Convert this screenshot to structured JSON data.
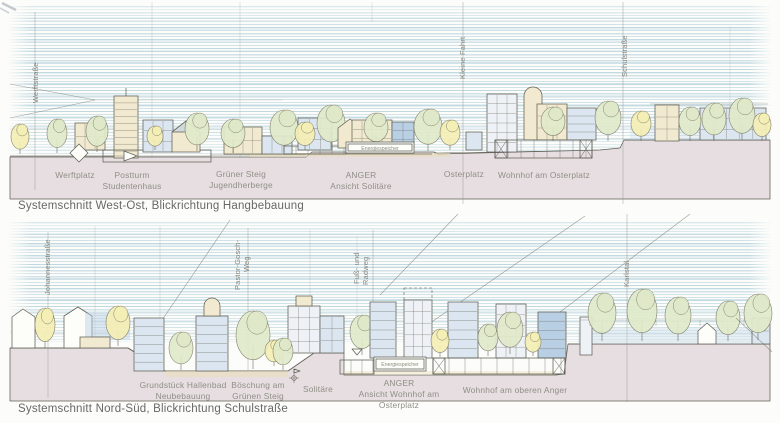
{
  "colors": {
    "paper": "#fcfcfa",
    "sky_stroke": "#7fb0c4",
    "ground": "#e7dee1",
    "pencil": "#5f5f55",
    "pencil_light": "#8f8f86",
    "street_label_text": "#85857f",
    "place_label_text": "#8f8f88",
    "annotation_text": "#8f8f84",
    "caption_text": "#686868",
    "fill_cream": "#f2ead0",
    "fill_yellow": "#f4eeb4",
    "fill_green": "#dfe9c9",
    "fill_blue": "#b9cfe4",
    "fill_bluepale": "#dce6f0",
    "fill_paleblue2": "#eef2f6",
    "fill_white": "#fdfdf9",
    "fill_sand": "#e9ddb4"
  },
  "panels": [
    {
      "name": "west-ost",
      "caption": "Systemschnitt West-Ost, Blickrichtung Hangbebauung",
      "street_labels": [
        {
          "name": "werftstrasse",
          "lines": [
            {
              "text": "Werftstraße",
              "x": 35,
              "y": 103
            }
          ]
        },
        {
          "name": "kleine-fahrt",
          "lines": [
            {
              "text": "Kleine Fahrt",
              "x": 462,
              "y": 79
            }
          ]
        },
        {
          "name": "schulstrasse",
          "lines": [
            {
              "text": "Schulstraße",
              "x": 624,
              "y": 77
            }
          ]
        }
      ],
      "place_labels": [
        {
          "name": "werftplatz",
          "x": 75,
          "y": 178,
          "lines": [
            "Werftplatz"
          ]
        },
        {
          "name": "postturm-studentenhaus",
          "x": 132,
          "y": 178,
          "lines": [
            "Postturm",
            "Studentenhaus"
          ]
        },
        {
          "name": "gruener-steig-jugendherberge",
          "x": 241,
          "y": 177,
          "lines": [
            "Grüner Steig",
            "Jugendherberge"
          ]
        },
        {
          "name": "anger-ansicht-solitaere",
          "x": 361,
          "y": 178,
          "lines": [
            "ANGER",
            "Ansicht Solitäre"
          ]
        },
        {
          "name": "osterplatz",
          "x": 464,
          "y": 177,
          "lines": [
            "Osterplatz"
          ]
        },
        {
          "name": "wohnhof-am-osterplatz",
          "x": 544,
          "y": 178,
          "lines": [
            "Wohnhof am Osterplatz"
          ]
        }
      ],
      "annotations": [
        {
          "name": "energiespeicher-top",
          "text": "Energiespeicher",
          "x": 380,
          "y": 150
        }
      ]
    },
    {
      "name": "nord-sued",
      "caption": "Systemschnitt Nord-Süd, Blickrichtung Schulstraße",
      "street_labels": [
        {
          "name": "johannesstrasse",
          "lines": [
            {
              "text": "Johannesstraße",
              "x": 47,
              "y": 295
            }
          ]
        },
        {
          "name": "pastor-gosch-weg",
          "lines": [
            {
              "text": "Pastor-Gosch-",
              "x": 237,
              "y": 290
            },
            {
              "text": "Weg",
              "x": 246,
              "y": 272
            }
          ]
        },
        {
          "name": "fuss-und-radweg",
          "lines": [
            {
              "text": "Fuß- und",
              "x": 356,
              "y": 284
            },
            {
              "text": "Radweg",
              "x": 365,
              "y": 285
            }
          ]
        },
        {
          "name": "karlstal",
          "lines": [
            {
              "text": "Karlstal",
              "x": 626,
              "y": 287
            }
          ]
        }
      ],
      "place_labels": [
        {
          "name": "grundstueck-hallenbad-neubebauung",
          "x": 183,
          "y": 388,
          "lines": [
            "Grundstück Hallenbad",
            "Neubebauung"
          ]
        },
        {
          "name": "boeschung-am-gruenen-steig",
          "x": 258,
          "y": 388,
          "lines": [
            "Böschung am",
            "Grünen Steig"
          ]
        },
        {
          "name": "solitaere",
          "x": 318,
          "y": 392,
          "lines": [
            "Solitäre"
          ]
        },
        {
          "name": "anger-ansicht-wohnhof-am-osterplatz",
          "x": 399,
          "y": 386,
          "lines": [
            "ANGER",
            "Ansicht Wohnhof am",
            "Osterplatz"
          ]
        },
        {
          "name": "wohnhof-am-oberen-anger",
          "x": 515,
          "y": 393,
          "lines": [
            "Wohnhof am oberen Anger"
          ]
        }
      ],
      "annotations": [
        {
          "name": "energiespeicher-bottom",
          "text": "Energiespeicher",
          "x": 400,
          "y": 366
        }
      ]
    }
  ]
}
